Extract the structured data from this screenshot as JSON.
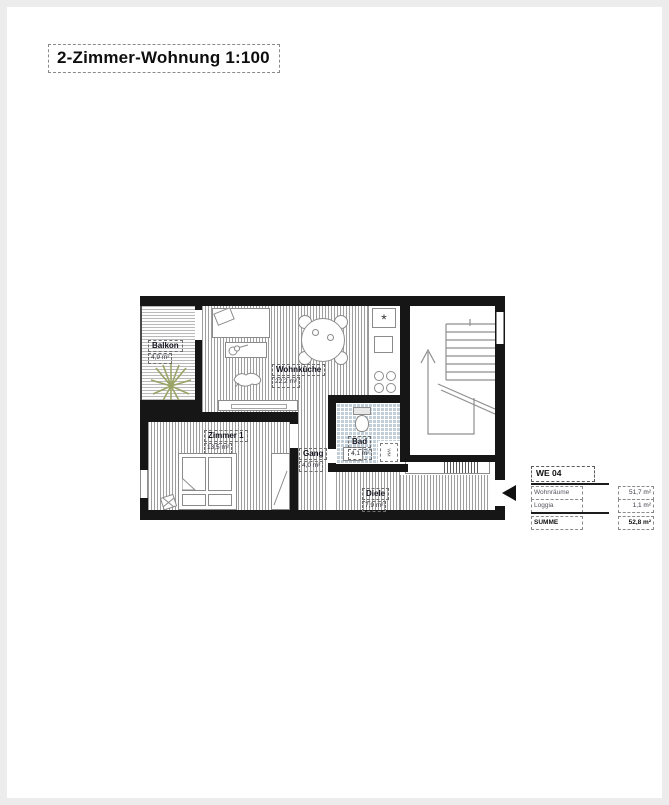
{
  "title": "2-Zimmer-Wohnung 1:100",
  "plan": {
    "rooms": [
      {
        "name": "Balkon",
        "area": "4,9 m²"
      },
      {
        "name": "Wohnküche",
        "area": "22,2 m²"
      },
      {
        "name": "Zimmer 1",
        "area": "13,5 m²"
      },
      {
        "name": "Gang",
        "area": "4,0 m²"
      },
      {
        "name": "Bad",
        "area": "4,1 m²"
      },
      {
        "name": "Diele",
        "area": "7,9 m²"
      }
    ],
    "symbols": {
      "freezer_star": "*",
      "washing_machine": "WM"
    }
  },
  "legend": {
    "unit": "WE 04",
    "rows": [
      {
        "label": "Wohnräume",
        "value": "51,7 m²"
      },
      {
        "label": "Loggia",
        "value": "1,1 m²"
      }
    ],
    "total": {
      "label": "SUMME",
      "value": "52,8 m²"
    }
  },
  "colors": {
    "wall": "#161616",
    "bath_tile": "#c2cfd9",
    "plant": "#9aa465",
    "floor_stripe": "#9e9e9e"
  }
}
